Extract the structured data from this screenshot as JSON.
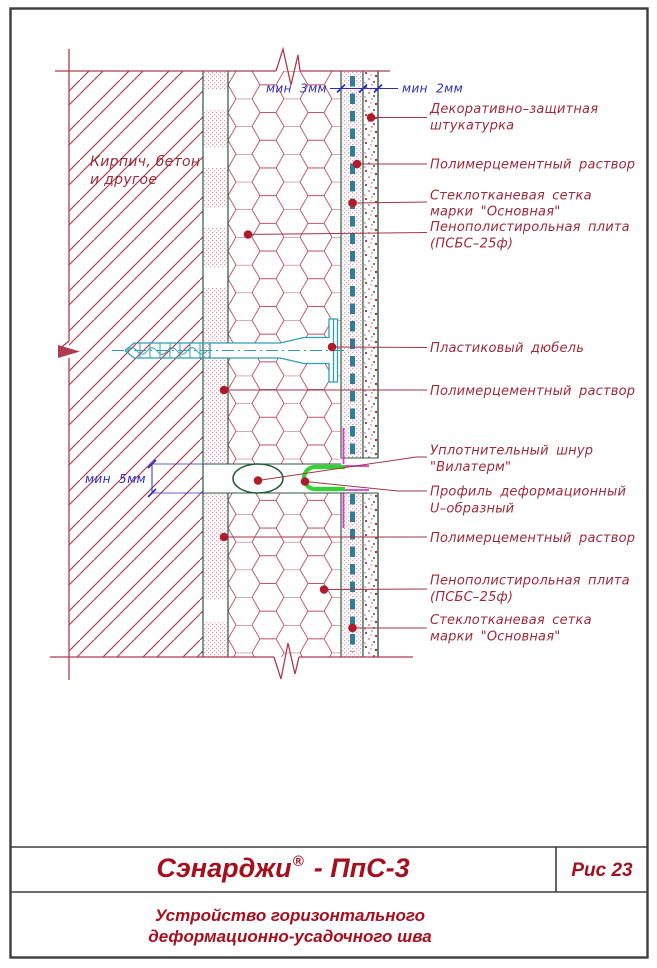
{
  "drawing": {
    "wall_material": {
      "line1": "Кирпич, бетон",
      "line2": "и другое"
    },
    "dimensions": {
      "mortar_mesh_min": "мин 3мм",
      "plaster_min": "мин 2мм",
      "joint_min": "мин 5мм"
    },
    "callouts": {
      "decorative_plaster": {
        "line1": "Декоративно–защитная",
        "line2": "штукатурка"
      },
      "polymer_mortar_top": "Полимерцементный раствор",
      "glass_mesh_top": {
        "line1": "Стеклотканевая сетка",
        "line2": "марки \"Основная\""
      },
      "foam_plate_top": {
        "line1": "Пенополистирольная плита",
        "line2": "(ПСБС–25ф)"
      },
      "plastic_dowel": "Пластиковый дюбель",
      "polymer_mortar_mid": "Полимерцементный раствор",
      "sealing_cord": {
        "line1": "Уплотнительный шнур",
        "line2": "\"Вилатерм\""
      },
      "deformation_profile": {
        "line1": "Профиль деформационный",
        "line2": "U–образный"
      },
      "polymer_mortar_bottom": "Полимерцементный раствор",
      "foam_plate_bottom": {
        "line1": "Пенополистирольная плита",
        "line2": "(ПСБС–25ф)"
      },
      "glass_mesh_bottom": {
        "line1": "Стеклотканевая сетка",
        "line2": "марки \"Основная\""
      }
    }
  },
  "title_block": {
    "brand": "Сэнарджи",
    "registered_mark": "®",
    "product_code": "- ПпС-3",
    "figure_number": "Рис 23",
    "caption": {
      "line1": "Устройство горизонтального",
      "line2": "деформационно-усадочного шва"
    }
  },
  "colors": {
    "title_red": "#a50f1e",
    "label_red": "#9e2a3a",
    "hatch_crimson": "#b03a50",
    "dim_blue": "#2c2cc0",
    "dowel_teal": "#2f9fb4",
    "mesh_teal": "#2e7d9b",
    "profile_green": "#32d435",
    "cord_magenta": "#d63ac8",
    "layer_green": "#2b5a3e",
    "border_gray": "#3d3d3d"
  }
}
